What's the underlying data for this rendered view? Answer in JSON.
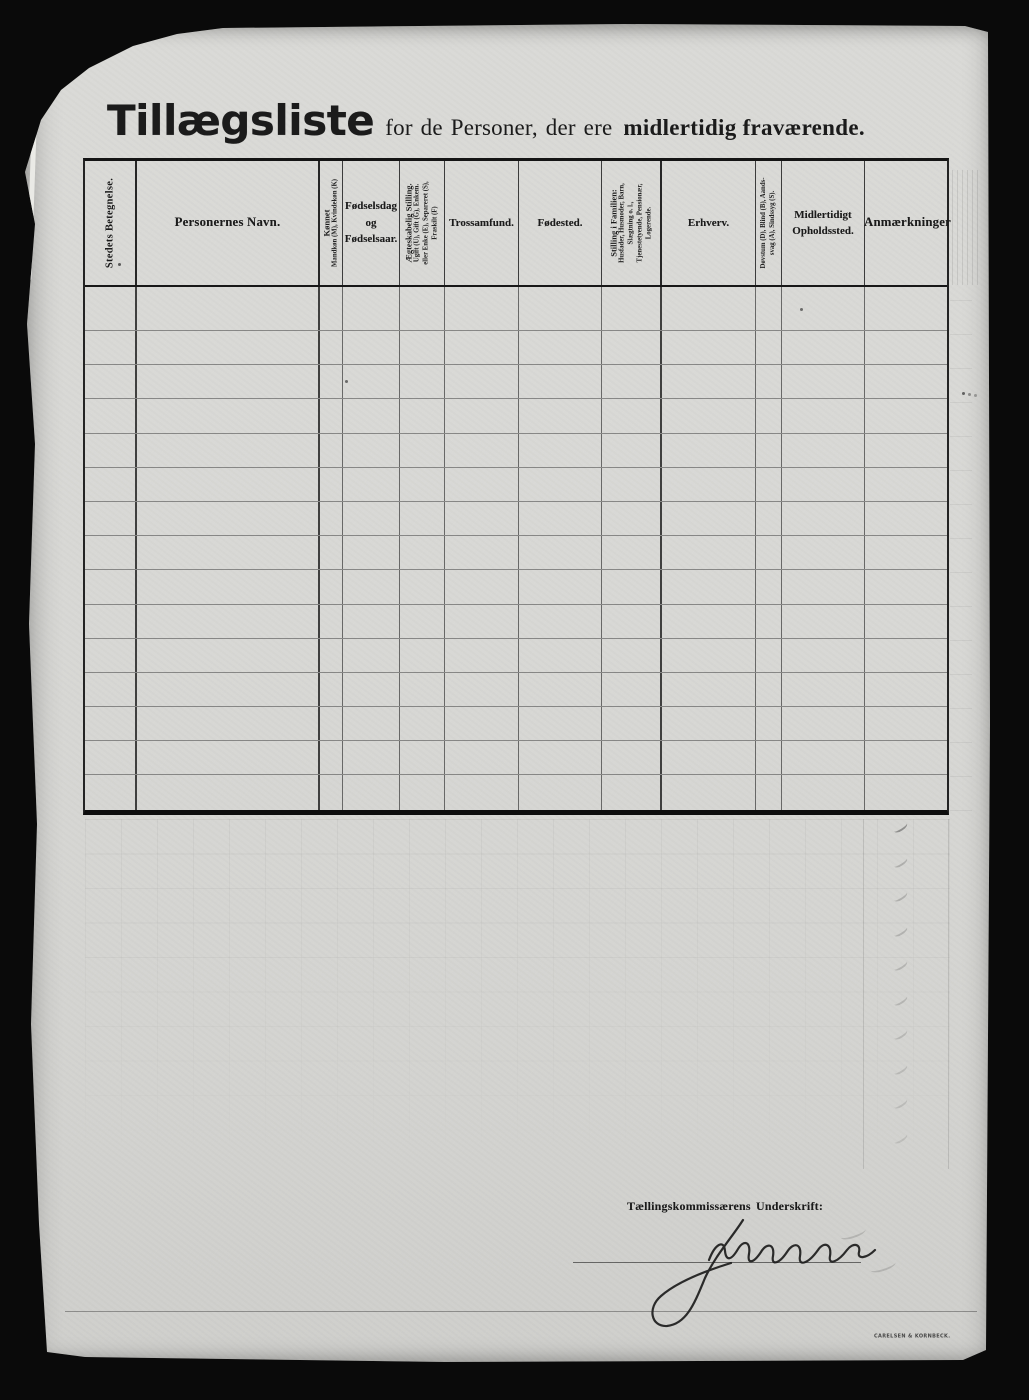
{
  "document": {
    "title": {
      "main": "Tillægsliste",
      "connector": "for de Personer, der ere",
      "emphasis": "midlertidig fraværende."
    }
  },
  "table": {
    "row_count": 15,
    "columns": [
      {
        "id": "stedets-betegnelse",
        "label": "Stedets Betegnelse.",
        "orientation": "vertical"
      },
      {
        "id": "personernes-navn",
        "label": "Personernes Navn.",
        "orientation": "horizontal",
        "emphasis": true
      },
      {
        "id": "koennet",
        "label": "Kønnet",
        "sublabel": "Mandkøn (M), Kvindekøn (K)",
        "orientation": "vertical"
      },
      {
        "id": "foedselsdag-og-foedselsaar",
        "label": "Fødselsdag\nog\nFødselsaar.",
        "orientation": "horizontal"
      },
      {
        "id": "aegteskabelig-stilling",
        "label": "Ægteskabelig Stilling.",
        "sublabel": "Ugift (U), Gift (G), Enkem.\neller Enke (E), Separeret (S),\nFraskilt (F)",
        "orientation": "vertical"
      },
      {
        "id": "trossamfund",
        "label": "Trossamfund.",
        "orientation": "horizontal"
      },
      {
        "id": "foedested",
        "label": "Fødested.",
        "orientation": "horizontal"
      },
      {
        "id": "stilling-i-familien",
        "label": "Stilling i Familien:",
        "sublabel": "Husfader, Husmoder, Barn,\nSlægtning o. l.,\nTjenestetyende, Pensionær,\nLogerende.",
        "orientation": "vertical"
      },
      {
        "id": "erhverv",
        "label": "Erhverv.",
        "orientation": "horizontal"
      },
      {
        "id": "doevstum-blind-aandssvag-sindssyg",
        "label": "Døvstum (D), Blind (B), Aands-\nsvag (A), Sindssyg (S).",
        "orientation": "vertical"
      },
      {
        "id": "midlertidigt-opholdssted",
        "label": "Midlertidigt\nOpholdssted.",
        "orientation": "horizontal"
      },
      {
        "id": "anmaerkninger",
        "label": "Anmærkninger",
        "orientation": "horizontal",
        "emphasis": true
      }
    ]
  },
  "footer": {
    "signature_caption": "Tællingskommissærens Underskrift:",
    "signature_transcription": "J. Nielsen",
    "printer_mark": "CARELSEN & KORNBECK."
  },
  "colors": {
    "frame": "#0a0a0a",
    "paper": "#d8d8d5",
    "ink": "#1b1b1b",
    "grid_line_vertical": "#2d2d2d",
    "grid_line_row": "#464646"
  }
}
